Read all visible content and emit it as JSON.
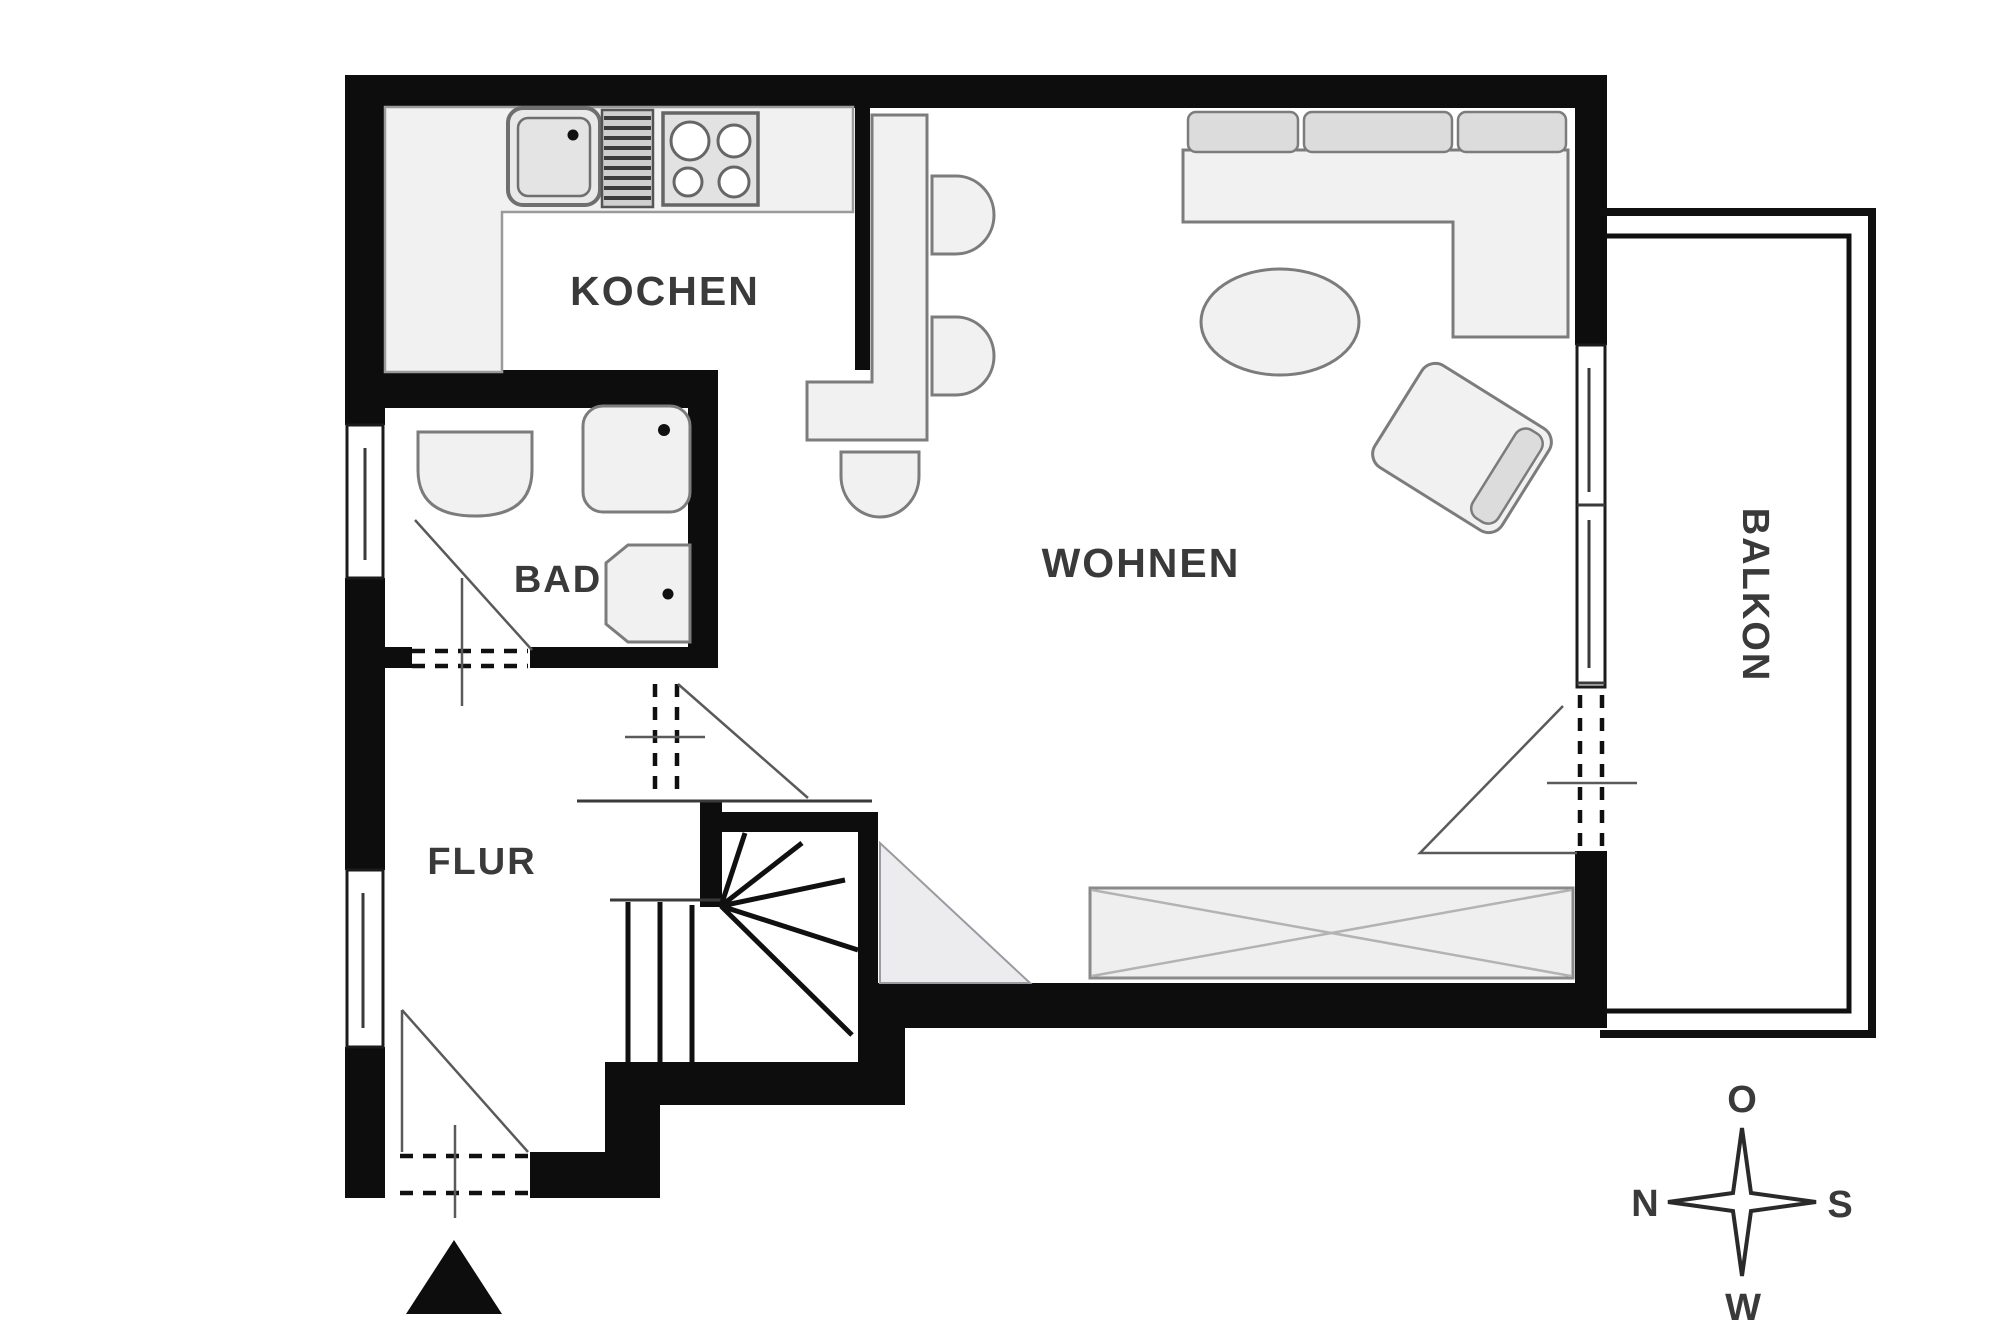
{
  "plan_title": "apartment floor plan",
  "rooms": {
    "kitchen": {
      "label": "KOCHEN"
    },
    "bath": {
      "label": "BAD"
    },
    "hall": {
      "label": "FLUR"
    },
    "living": {
      "label": "WOHNEN"
    },
    "balcony": {
      "label": "BALKON"
    }
  },
  "compass": {
    "top": "O",
    "left": "N",
    "right": "S",
    "bottom": "W"
  },
  "symbols": [
    "kitchen-sink-icon",
    "drainboard-icon",
    "stove-icon",
    "toilet-icon",
    "shower-icon",
    "washbasin-icon",
    "dining-table-icon",
    "chair-icon",
    "sofa-icon",
    "coffee-table-icon",
    "armchair-icon",
    "sideboard-icon",
    "stairs-icon",
    "door-swing-icon",
    "window-icon",
    "compass-rose-icon",
    "entrance-arrow-icon"
  ],
  "colors": {
    "wall": "#0d0d0d",
    "furniture_fill": "#f1f1f1",
    "furniture_stroke": "#7c7c7c",
    "cushion_fill": "#dcdcdc",
    "label": "#3a3a3a",
    "background": "#ffffff"
  }
}
